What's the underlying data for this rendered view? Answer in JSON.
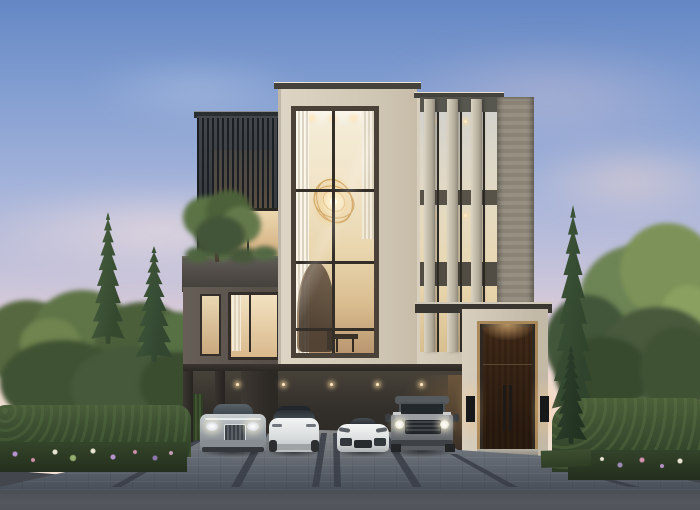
{
  "meta": {
    "description": "Dusk architectural rendering of a modern three-storey luxury house: beige travertine volumes, a dark timber-slat box, a double-height central window revealing a gold sphere chandelier and spiral staircase, vertical stone fins, a roof balcony with a tree, a tall timber entrance door with brass trim and wall sconces, and four cars (silver luxury sedan, white electric crossover, white sports car, grey boxy SUV) parked in the open carport, framed by conifers, clipped hedges, flower beds and a paved driveway."
  },
  "palette": {
    "sky_top": "#6487c4",
    "sky_mid": "#a3b3da",
    "sky_horizon": "#f3e2d3",
    "travertine": "#d4cbba",
    "dark_slats": "#3b3e42",
    "brown_stone": "#5f5750",
    "grey_stone": "#8f8a80",
    "window_frame": "#332e28",
    "warm_glass": "#e8d6b2",
    "chandelier_gold": "#d2a866",
    "door_wood": "#6e5843",
    "brass_trim": "#a9885a",
    "carport_dark": "#332f2b",
    "paver": "#6e747c",
    "paver_strip": "#3a3f46",
    "road": "#45494f",
    "hedge_green": "#3c5031",
    "conifer_green": "#42583e",
    "flower_purple": "#b793cc",
    "flower_pink": "#d190ab",
    "flower_white": "#e9e4d2"
  },
  "scene": {
    "time_of_day": "dusk",
    "building": {
      "storeys": 3,
      "materials": [
        "beige travertine",
        "dark timber slats",
        "brown stone",
        "grey stone",
        "glass"
      ],
      "features": [
        "double-height central window",
        "gold sphere chandelier",
        "spiral staircase",
        "vertical fins",
        "roof balcony with tree",
        "open carport on pillars",
        "tall timber entrance door with brass frame",
        "wall sconces"
      ]
    },
    "cars": [
      {
        "type": "luxury sedan",
        "color": "silver"
      },
      {
        "type": "electric crossover",
        "color": "white"
      },
      {
        "type": "sports car",
        "color": "white"
      },
      {
        "type": "off-road SUV",
        "color": "grey"
      }
    ],
    "landscape": [
      "pine trees",
      "deciduous trees",
      "clipped hedges",
      "flower beds purple pink white",
      "lawn strip",
      "paved driveway with dark banding",
      "asphalt road"
    ]
  }
}
